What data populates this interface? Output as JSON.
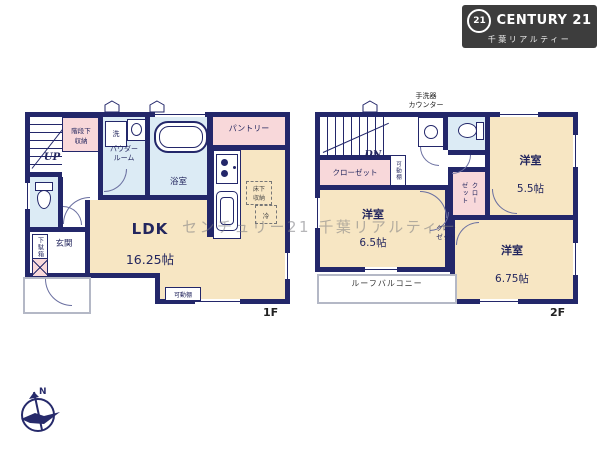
{
  "logo": {
    "badge": "21",
    "brand": "CENTURY 21",
    "subtitle": "千葉リアルティー"
  },
  "watermark": "センチュリー21 千葉リアルティー",
  "compass": {
    "north": "N"
  },
  "floor1": {
    "label": "1F",
    "stair_storage": "階段下\n収納",
    "up": "UP",
    "laundry": "洗",
    "powder_room": "パウダー\nルーム",
    "bath": "浴室",
    "pantry": "パントリー",
    "shoe_cabinet": "下駄箱",
    "entrance": "玄関",
    "ldk_name": "LDK",
    "ldk_size": "16.25帖",
    "underfloor_storage": "床下\n収納",
    "fridge": "冷",
    "shelf": "可動棚"
  },
  "floor2": {
    "label": "2F",
    "handwash_counter": "手洗器\nカウンター",
    "down": "DN",
    "closet_hall": "クローゼット",
    "shelf": "可動棚",
    "room_a_name": "洋室",
    "room_a_size": "5.5帖",
    "room_b_name": "洋室",
    "room_b_size": "6.5帖",
    "room_c_name": "洋室",
    "room_c_size": "6.75帖",
    "closet_side": "クロー\nゼット",
    "closet_small": "クロー\nゼット",
    "balcony": "ルーフバルコニー"
  },
  "colors": {
    "wall": "#23276a",
    "room": "#f7e6c3",
    "wet_area": "#dcebf5",
    "closet": "#f8d8da",
    "logo_bg": "#3d3d3d"
  }
}
